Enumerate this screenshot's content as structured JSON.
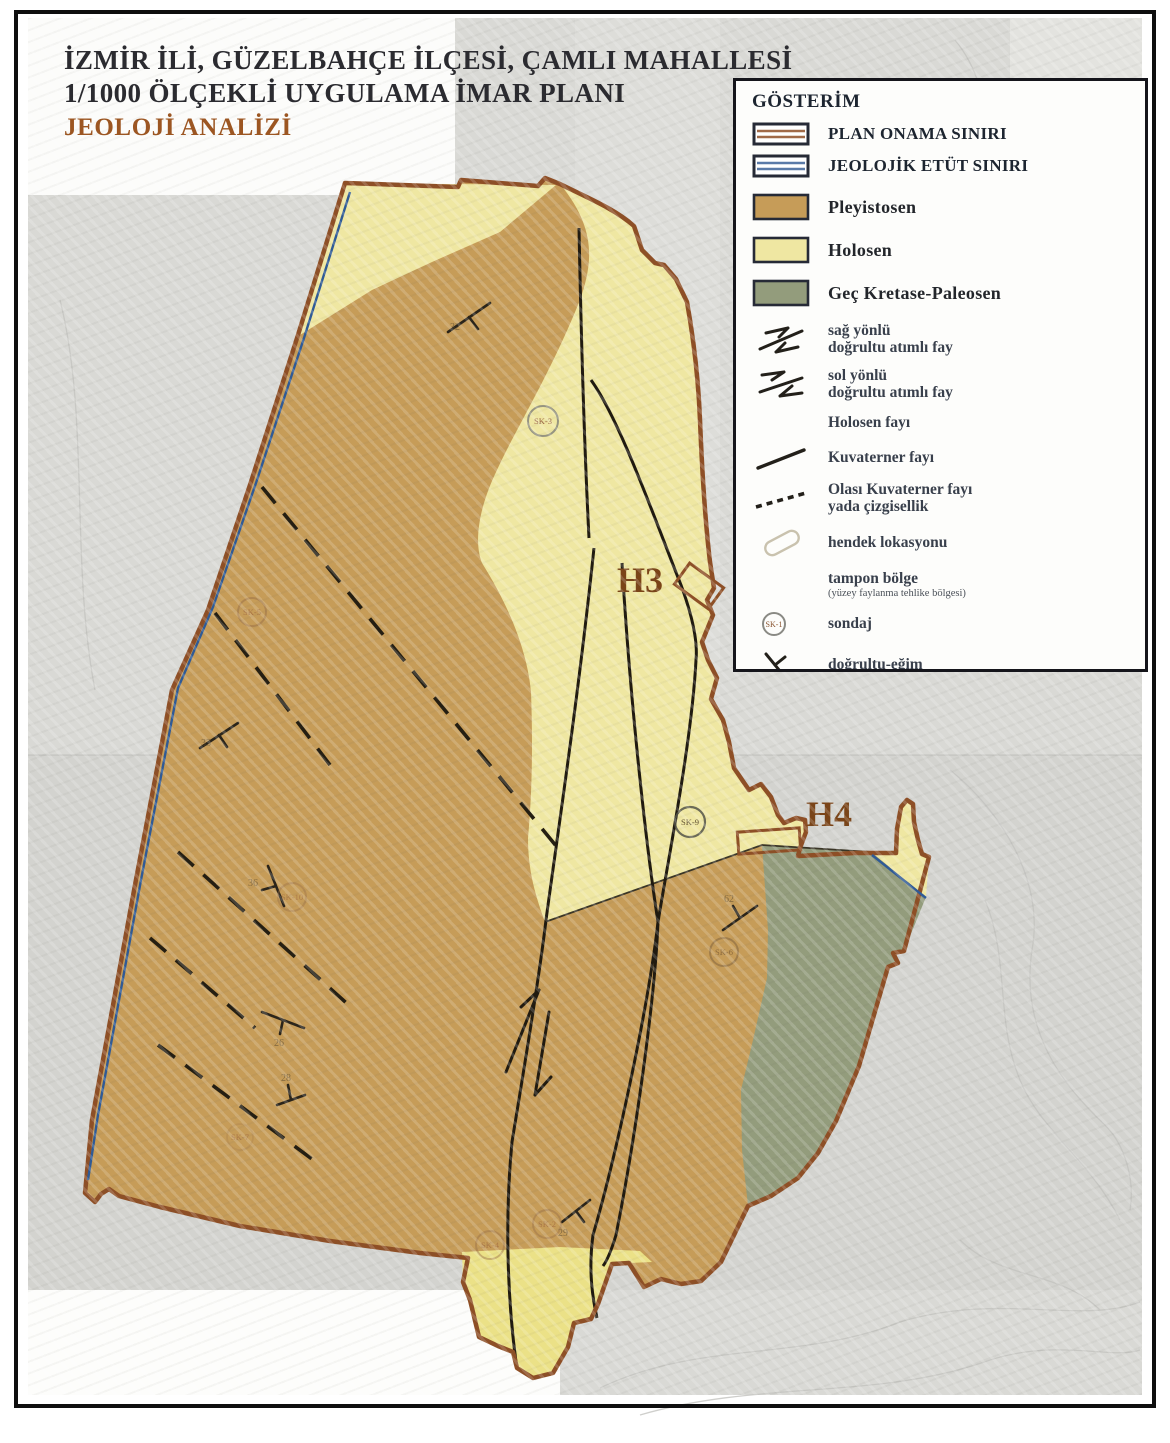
{
  "title": {
    "line1": "İZMİR İLİ, GÜZELBAHÇE İLÇESİ, ÇAMLI MAHALLESİ",
    "line2": "1/1000 ÖLÇEKLİ UYGULAMA İMAR PLANI",
    "line3": "JEOLOJİ ANALİZİ"
  },
  "legend": {
    "title": "GÖSTERİM",
    "items": [
      {
        "label": "PLAN ONAMA SINIRI",
        "symbol": "brown-striped-boundary-swatch"
      },
      {
        "label": "JEOLOJİK ETÜT SINIRI",
        "symbol": "blue-striped-boundary-swatch"
      },
      {
        "label": "Pleyistosen",
        "symbol": "fill-swatch",
        "color": "#c69c58"
      },
      {
        "label": "Holosen",
        "symbol": "fill-swatch",
        "color": "#efe7a2"
      },
      {
        "label": "Geç Kretase-Paleosen",
        "symbol": "fill-swatch",
        "color": "#939c7c"
      },
      {
        "label": "sağ yönlü",
        "label2": "doğrultu atımlı fay",
        "symbol": "right-lateral-fault"
      },
      {
        "label": "sol yönlü",
        "label2": "doğrultu atımlı fay",
        "symbol": "left-lateral-fault"
      },
      {
        "label": "Holosen fayı",
        "symbol": "none"
      },
      {
        "label": "Kuvaterner fayı",
        "symbol": "solid-fault-line"
      },
      {
        "label": "Olası Kuvaterner fayı",
        "label2": "yada çizgisellik",
        "symbol": "dashed-fault-line"
      },
      {
        "label": "hendek lokasyonu",
        "symbol": "trench-outline"
      },
      {
        "label": "tampon bölge",
        "label2": "(yüzey faylanma tehlike bölgesi)",
        "symbol": "none"
      },
      {
        "label": "sondaj",
        "symbol": "borehole-circle",
        "symbol_text": "SK-1"
      },
      {
        "label": "doğrultu-eğim",
        "symbol": "strike-dip"
      }
    ]
  },
  "map": {
    "trenches": [
      {
        "label": "H3"
      },
      {
        "label": "H4"
      }
    ],
    "boreholes": [
      {
        "id": "SK-3"
      },
      {
        "id": "SK-5"
      },
      {
        "id": "SK-10"
      },
      {
        "id": "SK-7"
      },
      {
        "id": "SK-9"
      },
      {
        "id": "SK-6"
      },
      {
        "id": "SK-4"
      },
      {
        "id": "SK-2"
      }
    ],
    "dips": [
      {
        "value": "32"
      },
      {
        "value": "33"
      },
      {
        "value": "36"
      },
      {
        "value": "26"
      },
      {
        "value": "28"
      },
      {
        "value": "62"
      },
      {
        "value": "29"
      }
    ],
    "unit_colors": {
      "pleyistosen": "#c69c58",
      "holosen": "#efe7a2",
      "holosen_tip": "#ebe187",
      "gec_kretase_paleosen": "#939c7c",
      "plan_onama_sinir": "#8e4f26",
      "jeolojik_etut_sinir": "#2f5a96",
      "fault": "#201a10"
    }
  }
}
